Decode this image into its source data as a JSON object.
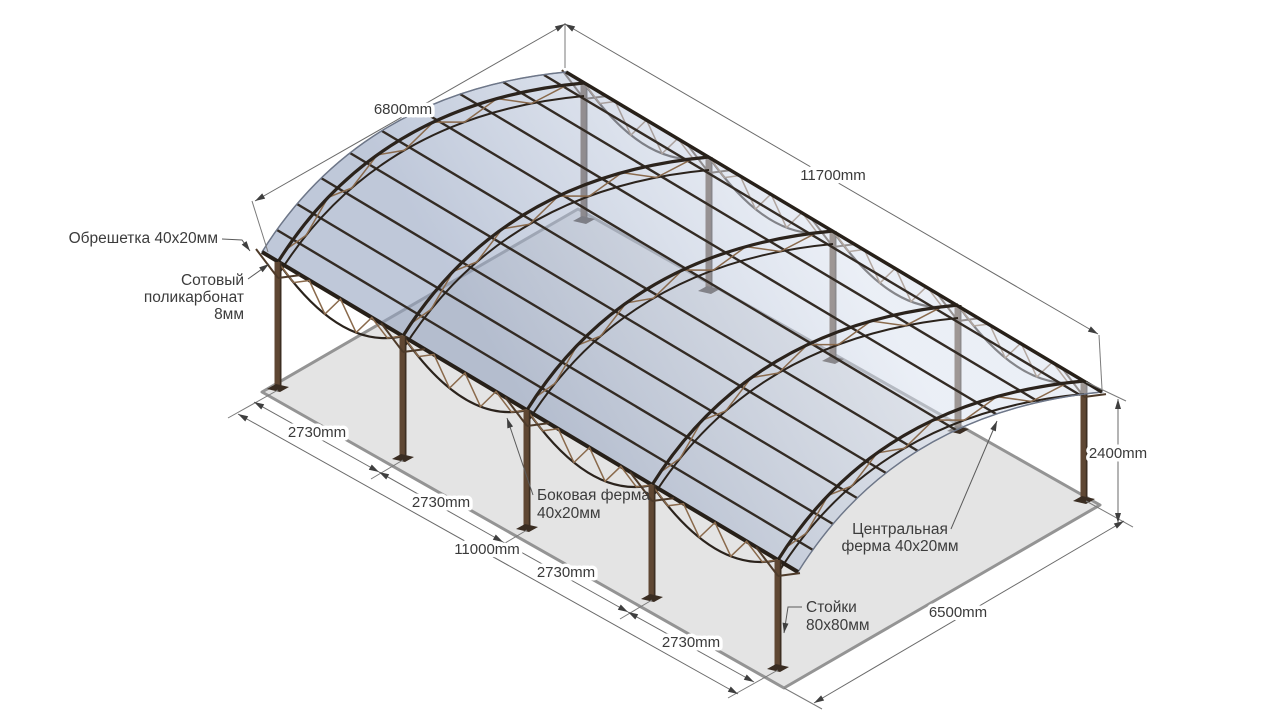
{
  "dimensions": {
    "roof_width": "6800mm",
    "roof_length": "11700mm",
    "height": "2400mm",
    "ground_depth": "6500mm",
    "posts_span": "11000mm",
    "bay_spacings": [
      "2730mm",
      "2730mm",
      "2730mm",
      "2730mm"
    ]
  },
  "part_labels": {
    "battens": "Обрешетка 40х20мм",
    "polycarbonate_lines": [
      "Сотовый",
      "поликарбонат",
      "8мм"
    ],
    "side_truss_lines": [
      "Боковая ферма",
      "40х20мм"
    ],
    "central_truss_lines": [
      "Центральная",
      "ферма 40х20мм"
    ],
    "posts_lines": [
      "Стойки",
      "80х80мм"
    ]
  },
  "colors": {
    "roof_panel": "#c7d0e0",
    "metal_frame": "#2e2620",
    "truss_web": "#8a6a4c",
    "wood_post": "#5f4733",
    "ground": "#e4e4e4",
    "dimension_lines": "#6a6a6a",
    "text": "#3a3a3a"
  }
}
